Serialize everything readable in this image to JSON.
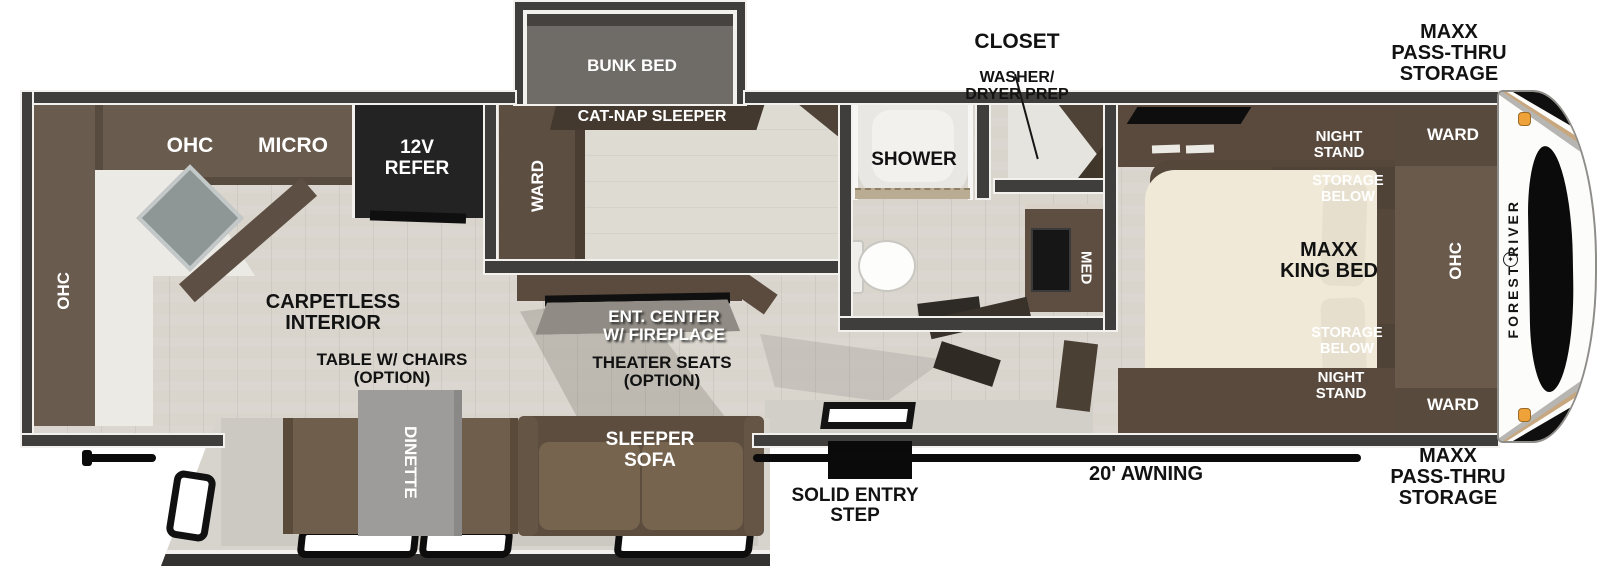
{
  "colors": {
    "wall": "#3f3e3c",
    "floor": "#d9d5cd",
    "cabinet": "#695b4e",
    "cabinet_dark": "#4f4236",
    "bed": "#f0e9d8",
    "marker_light": "#f0a23a",
    "accent_tan": "#c8a77e"
  },
  "exterior": {
    "closet_callout": {
      "title": "CLOSET",
      "subtitle": "WASHER/\nDRYER PREP"
    },
    "storage_front_top": "MAXX\nPASS-THRU\nSTORAGE",
    "storage_front_bottom": "MAXX\nPASS-THRU\nSTORAGE",
    "awning": "20' AWNING",
    "entry_step": "SOLID ENTRY\nSTEP",
    "brand_vertical": "FOREST RIVER",
    "logo_glyph": "✦"
  },
  "kitchen": {
    "ohc_top": "OHC",
    "micro": "MICRO",
    "refer": "12V\nREFER",
    "ohc_rear": "OHC"
  },
  "bunk_room": {
    "ward": "WARD",
    "bunk_bed": "BUNK BED",
    "cat_nap_sleeper": "CAT-NAP SLEEPER"
  },
  "living": {
    "carpetless": "CARPETLESS\nINTERIOR",
    "ent_center": "ENT. CENTER\nW/ FIREPLACE",
    "theater_seats": "THEATER SEATS\n(OPTION)",
    "table_chairs": "TABLE W/ CHAIRS\n(OPTION)",
    "dinette": "DINETTE",
    "sleeper_sofa": "SLEEPER\nSOFA"
  },
  "bathroom": {
    "shower": "SHOWER",
    "med": "MED"
  },
  "bedroom": {
    "night_stand_top": "NIGHT\nSTAND",
    "storage_below_top": "STORAGE\nBELOW",
    "king_bed": "MAXX\nKING BED",
    "storage_below_bottom": "STORAGE\nBELOW",
    "night_stand_bottom": "NIGHT\nSTAND",
    "ward_top": "WARD",
    "ohc": "OHC",
    "ward_bottom": "WARD"
  }
}
